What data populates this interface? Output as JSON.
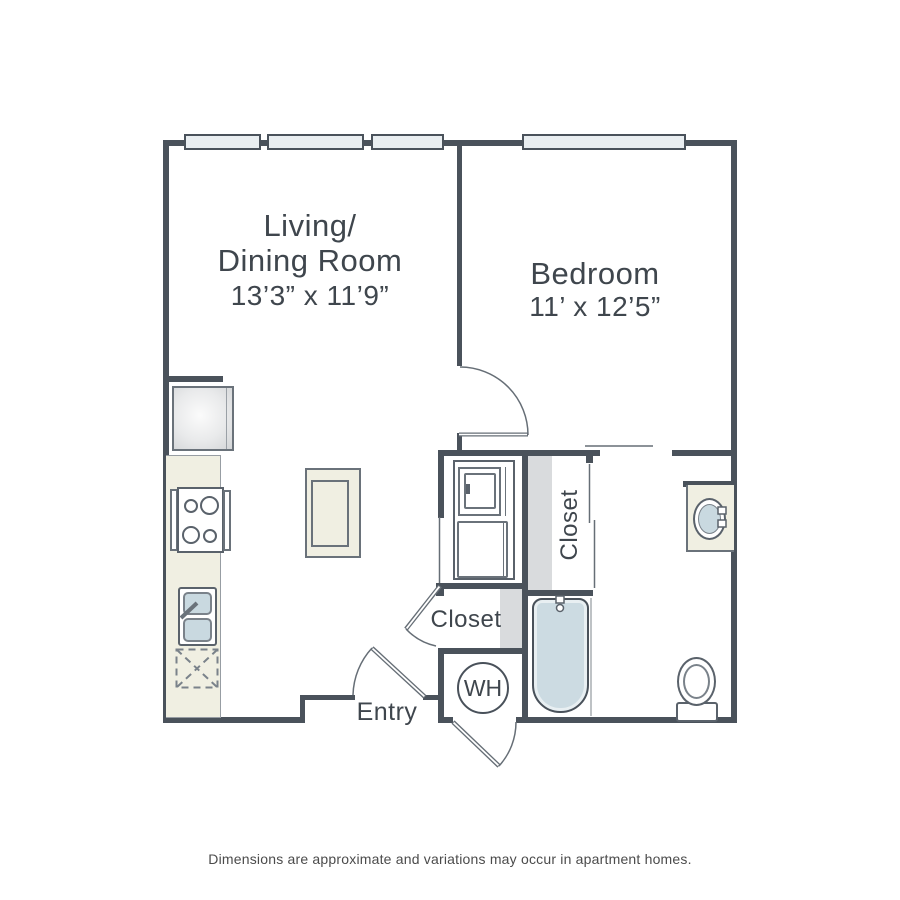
{
  "canvas": {
    "width": 900,
    "height": 900
  },
  "rooms": {
    "living_dining": {
      "name_line1": "Living/",
      "name_line2": "Dining Room",
      "dimensions": "13’3” x 11’9”"
    },
    "bedroom": {
      "name": "Bedroom",
      "dimensions": "11’ x 12’5”"
    },
    "bedroom_closet": {
      "name": "Closet"
    },
    "hall_closet": {
      "name": "Closet"
    },
    "entry": {
      "name": "Entry"
    },
    "water_heater": {
      "label": "WH"
    }
  },
  "footer": {
    "disclaimer": "Dimensions are approximate and variations may occur in apartment homes."
  },
  "fixtures": [
    "refrigerator",
    "range",
    "kitchen-sink",
    "dishwasher",
    "kitchen-island",
    "stacked-washer-dryer",
    "water-heater",
    "bathtub",
    "vanity-sink",
    "toilet"
  ],
  "colors": {
    "wall": "#4a525b",
    "fixture_line": "#666e76",
    "window_fill": "#e9eef1",
    "counter_beige": "#f0efe2",
    "closet_shade": "#d9dbdd",
    "water_blue": "#ccdbe2",
    "label_text": "#3f464d",
    "footer_text": "#4b4b4b"
  }
}
